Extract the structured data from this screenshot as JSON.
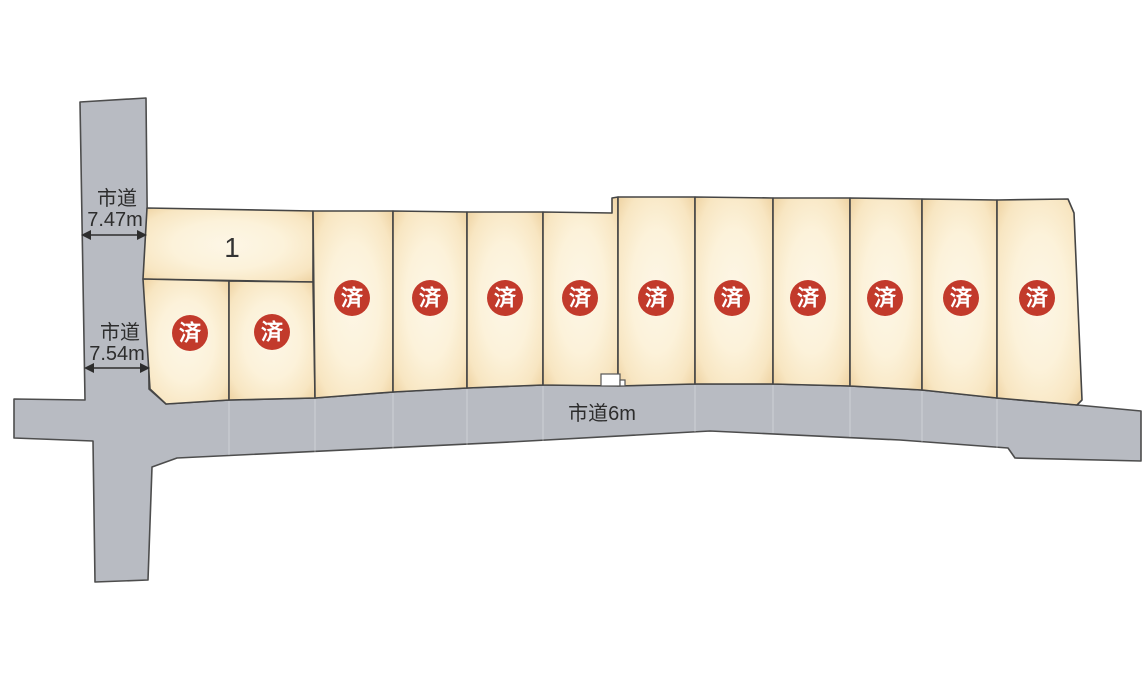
{
  "map": {
    "type": "residential-lot-layout",
    "total_plots": 13,
    "sold_count": 12,
    "available_count": 1
  },
  "colors": {
    "road": "#b8bbc2",
    "plot_center": "#fdf6e6",
    "plot_edge": "#edd09e",
    "outline": "#454545",
    "sold_badge": "#c23a2b",
    "badge_text": "#ffffff",
    "label_text": "#2d2d2d"
  },
  "roads": {
    "left_upper": {
      "name": "市道",
      "width": "7.47m"
    },
    "left_lower": {
      "name": "市道",
      "width": "7.54m"
    },
    "bottom": {
      "name": "市道6m"
    }
  },
  "plots": [
    {
      "id": "1",
      "label": "1",
      "status": "available"
    },
    {
      "id": "2",
      "label": "済",
      "status": "sold"
    },
    {
      "id": "3",
      "label": "済",
      "status": "sold"
    },
    {
      "id": "4",
      "label": "済",
      "status": "sold"
    },
    {
      "id": "5",
      "label": "済",
      "status": "sold"
    },
    {
      "id": "6",
      "label": "済",
      "status": "sold"
    },
    {
      "id": "7",
      "label": "済",
      "status": "sold"
    },
    {
      "id": "8",
      "label": "済",
      "status": "sold"
    },
    {
      "id": "9",
      "label": "済",
      "status": "sold"
    },
    {
      "id": "10",
      "label": "済",
      "status": "sold"
    },
    {
      "id": "11",
      "label": "済",
      "status": "sold"
    },
    {
      "id": "12",
      "label": "済",
      "status": "sold"
    },
    {
      "id": "13",
      "label": "済",
      "status": "sold"
    }
  ]
}
